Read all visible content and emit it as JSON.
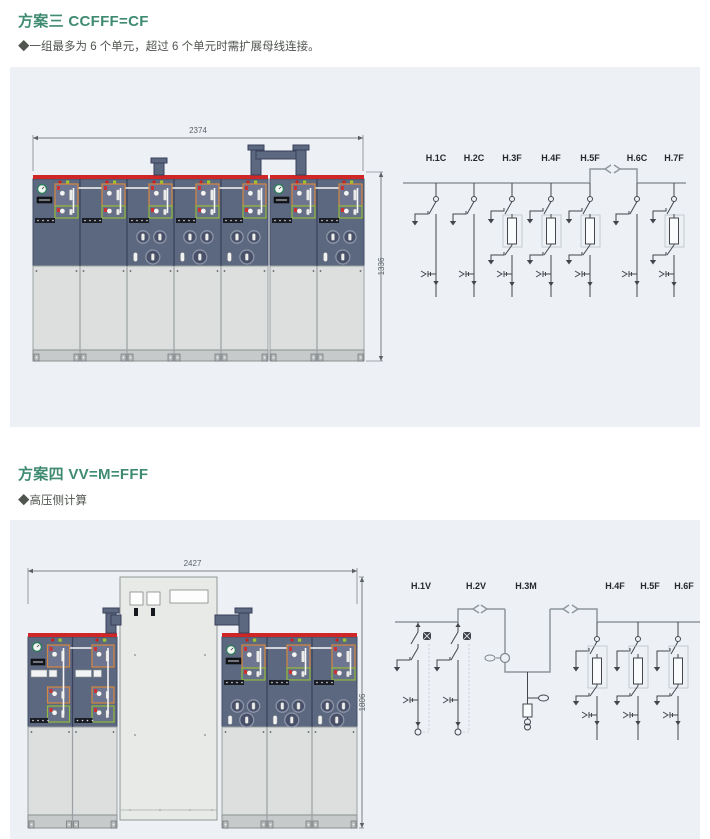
{
  "page": {
    "colors": {
      "page_bg": "#ffffff",
      "panel_bg": "#edf1f6",
      "title": "#3f8b71",
      "note": "#50554f",
      "cabinet_body": "#5c6780",
      "cabinet_line": "#454e64",
      "red_strip": "#cf2727",
      "orange_box": "#d4873f",
      "green_box": "#92ba3b",
      "door": "#dcdfde",
      "door_line": "#9ba1a1",
      "rail": "#c6caca",
      "fuse_circle": "#49516a",
      "fuse_ring": "#8d96a8",
      "white_cable": "#f6f7f8",
      "mid_cabinet": "#e8eae7",
      "bus_gray": "#8e969c",
      "symbol": "#43474c",
      "dim": "#5c6166",
      "indicator_red": "#cc2020",
      "indicator_green": "#a4c42c"
    }
  },
  "schemes": [
    {
      "title": "方案三 CCFFF=CF",
      "note": "◆一组最多为 6 个单元，超过 6 个单元时需扩展母线连接。",
      "cabinet": {
        "top_dim": "2374",
        "side_dim": "1336",
        "blocks": [
          {
            "units": [
              "C",
              "C",
              "F",
              "F",
              "F"
            ]
          },
          {
            "units": [
              "C",
              "F"
            ]
          }
        ]
      },
      "diagram": {
        "columns": [
          {
            "label": "H.1C",
            "type": "C"
          },
          {
            "label": "H.2C",
            "type": "C"
          },
          {
            "label": "H.3F",
            "type": "F"
          },
          {
            "label": "H.4F",
            "type": "F"
          },
          {
            "label": "H.5F",
            "type": "F"
          },
          {
            "label": "H.6C",
            "type": "C"
          },
          {
            "label": "H.7F",
            "type": "F"
          }
        ],
        "coupler_between": [
          "H.5F",
          "H.6C"
        ]
      }
    },
    {
      "title": "方案四 VV=M=FFF",
      "note": "◆高压侧计算",
      "cabinet": {
        "top_dim": "2427",
        "side_dim": "1806",
        "blocks": [
          {
            "units": [
              "V",
              "V"
            ]
          },
          {
            "units": [
              "M"
            ]
          },
          {
            "units": [
              "F",
              "F",
              "F"
            ]
          }
        ]
      },
      "diagram": {
        "columns": [
          {
            "label": "H.1V",
            "type": "V"
          },
          {
            "label": "H.2V",
            "type": "V"
          },
          {
            "label": "H.3M",
            "type": "M"
          },
          {
            "label": "H.4F",
            "type": "F"
          },
          {
            "label": "H.5F",
            "type": "F"
          },
          {
            "label": "H.6F",
            "type": "F"
          }
        ],
        "coupler_between": [
          "H.2V",
          "H.3M",
          "H.4F"
        ]
      }
    }
  ]
}
